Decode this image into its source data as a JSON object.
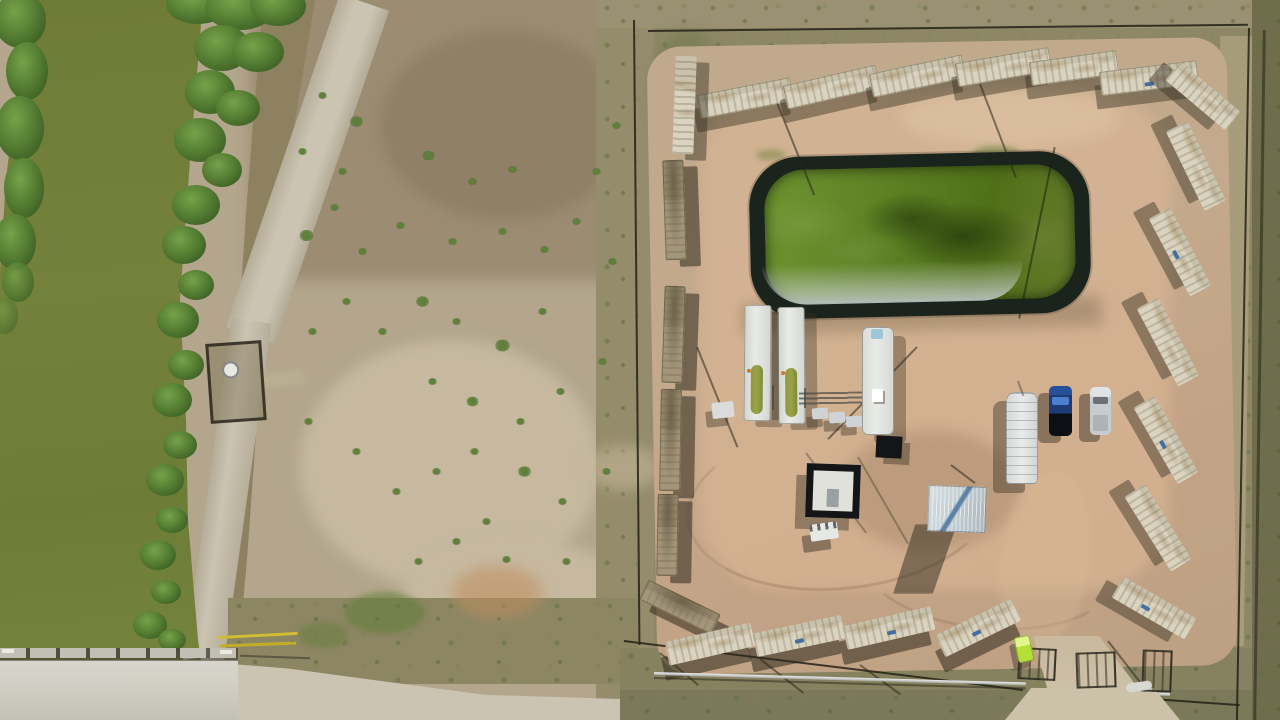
{
  "scene": {
    "type": "aerial-drone-photograph",
    "description": "Top-down aerial view of a fenced oil-and-gas well pad compound walled with shipping containers, with a green lined retention pond, equipment skids, trailers and pickup trucks inside; a green irrigation canal with vegetated banks and a concrete bridge on the left; bare scrubland and a dirt road between them.",
    "time_of_day": "midday"
  },
  "palette": {
    "field-base": "#b3a68c",
    "field-dark": "#9b8c72",
    "field-dark2": "#8f8066",
    "field-light": "#c6b9a0",
    "road-light": "#cbc4b2",
    "bank-dry": "#8e8160",
    "scrub-strip": "#958c6c",
    "veg-dark": "#3f6226",
    "veg-mid": "#567f33",
    "veg-light": "#77a24a",
    "shrub": "#5e8038",
    "canal-water": "#73813a",
    "surround": "#8e8766",
    "surround-dark": "#6f6d4b",
    "grass-south": "#86825f",
    "fence": "#23211a",
    "pad": "#c4a98c",
    "pad-bright": "#d4b598",
    "pond-liner": "#1b231d",
    "pond-water": "#5a7d22",
    "pond-silver": "#ccd2d6",
    "container-face": "#d9d3c0",
    "container-tan": "#a3957a",
    "equip-white": "#e9ebe8",
    "tank-green": "#9aa348",
    "truck-blue": "#1d3c77",
    "truck-glass": "#4d7fd0",
    "truck-silver": "#c6cbcf",
    "shelter": "#c3ced3",
    "shelter-blue": "#5b82a6",
    "black-unit": "#141517",
    "portapotty": "#b6df3a",
    "bridge": "#d2cfc5",
    "gate-yellow": "#d2bc34",
    "pipe-silver": "#d9dad6",
    "orange-dirt": "#c08d5c",
    "shadow": "rgba(56,48,34,0.45)",
    "shadow-dk": "rgba(48,42,30,0.55)"
  },
  "objects": {
    "canal": "irrigation canal with algae-green water",
    "canal_banks": "dense reed and brush vegetation on both banks",
    "bridge": "concrete road bridge with guardrail crossing the canal",
    "yellow_gate": "yellow pipe gate at field entrance",
    "culvert": "dark culvert opening in canal bank",
    "wellhead_enclosure": "small fenced enclosure with white circular wellhead on canal bank",
    "dirt_road": "light dirt road running diagonally beside the canal",
    "scrubland": "bare cleared field with scattered green shrubs",
    "compound": {
      "perimeter_fence": "dark wire fence around the pad",
      "container_wall": {
        "top": 6,
        "right": 6,
        "left": 6,
        "bottom": 4,
        "corner": 2
      },
      "retention_pond": "black-lined pond with green algae water and silver liner edge",
      "equipment_skids": 2,
      "semi_trailer": "white semi trailer",
      "manifold": "piping manifold with three small tanks",
      "cellar": "black-framed square wellhead cellar",
      "generator": "small white generator unit",
      "shelter": "corrugated metal shelter with blue streak",
      "utility_trailer": "white gridded utility trailer",
      "pickup_blue": "dark blue pickup truck",
      "pickup_silver": "silver pickup truck",
      "portable_toilet": "bright yellow-green portable toilet",
      "entrance_gates": "metal pipe gate panels at south entrance",
      "entrance_road": "dirt access road through south gate",
      "light_pole_shadows": 7
    }
  }
}
